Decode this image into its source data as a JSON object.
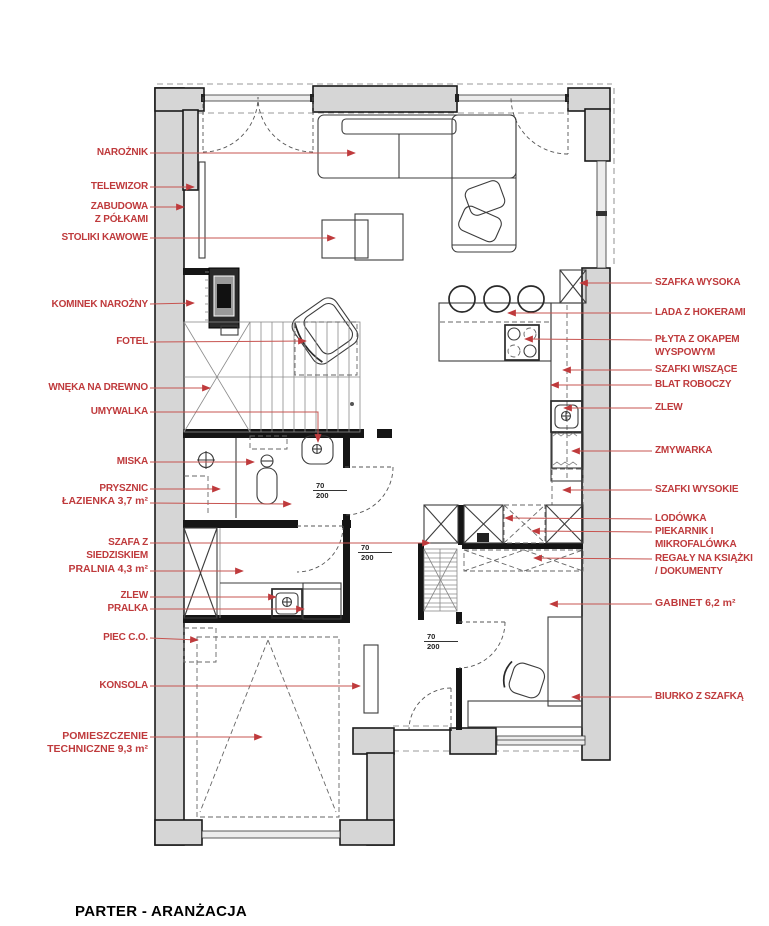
{
  "title": "PARTER - ARANŻACJA",
  "colors": {
    "annotation": "#bf3a3c",
    "leader": "#c75450",
    "wall_fill": "#d6d6d6",
    "wall_stroke": "#1a1a1a"
  },
  "plan": {
    "door_dimensions": [
      {
        "width": "70",
        "height": "200"
      },
      {
        "width": "70",
        "height": "200"
      },
      {
        "width": "70",
        "height": "200"
      }
    ]
  },
  "annotations": {
    "left": [
      {
        "id": "naroznik",
        "lines": [
          "NAROŻNIK"
        ]
      },
      {
        "id": "telewizor",
        "lines": [
          "TELEWIZOR"
        ]
      },
      {
        "id": "zabudowa",
        "lines": [
          "ZABUDOWA",
          "Z PÓŁKAMI"
        ]
      },
      {
        "id": "stoliki",
        "lines": [
          "STOLIKI KAWOWE"
        ]
      },
      {
        "id": "kominek",
        "lines": [
          "KOMINEK NAROŻNY"
        ]
      },
      {
        "id": "fotel",
        "lines": [
          "FOTEL"
        ]
      },
      {
        "id": "wneka",
        "lines": [
          "WNĘKA NA DREWNO"
        ]
      },
      {
        "id": "umywalka",
        "lines": [
          "UMYWALKA"
        ]
      },
      {
        "id": "miska",
        "lines": [
          "MISKA"
        ]
      },
      {
        "id": "prysznic",
        "lines": [
          "PRYSZNIC"
        ]
      },
      {
        "id": "lazienka",
        "lines": [
          "ŁAZIENKA 3,7 m²"
        ]
      },
      {
        "id": "szafa",
        "lines": [
          "SZAFA Z",
          "SIEDZISKIEM"
        ]
      },
      {
        "id": "pralnia",
        "lines": [
          "PRALNIA 4,3 m²"
        ]
      },
      {
        "id": "zlew-lewy",
        "lines": [
          "ZLEW"
        ]
      },
      {
        "id": "pralka",
        "lines": [
          "PRALKA"
        ]
      },
      {
        "id": "piec",
        "lines": [
          "PIEC C.O."
        ]
      },
      {
        "id": "konsola",
        "lines": [
          "KONSOLA"
        ]
      },
      {
        "id": "pomieszczenie",
        "lines": [
          "POMIESZCZENIE",
          "TECHNICZNE 9,3 m²"
        ]
      }
    ],
    "right": [
      {
        "id": "szafka-wysoka",
        "lines": [
          "SZAFKA WYSOKA"
        ]
      },
      {
        "id": "lada",
        "lines": [
          "LADA Z HOKERAMI"
        ]
      },
      {
        "id": "plyta",
        "lines": [
          "PŁYTA Z OKAPEM",
          "WYSPOWYM"
        ]
      },
      {
        "id": "szafki-wiszace",
        "lines": [
          "SZAFKI WISZĄCE"
        ]
      },
      {
        "id": "blat",
        "lines": [
          "BLAT ROBOCZY"
        ]
      },
      {
        "id": "zlew-prawy",
        "lines": [
          "ZLEW"
        ]
      },
      {
        "id": "zmywarka",
        "lines": [
          "ZMYWARKA"
        ]
      },
      {
        "id": "szafki-wysokie",
        "lines": [
          "SZAFKI WYSOKIE"
        ]
      },
      {
        "id": "lodowka",
        "lines": [
          "LODÓWKA",
          "PIEKARNIK I",
          "MIKROFALÓWKA"
        ]
      },
      {
        "id": "regaly",
        "lines": [
          "REGAŁY NA KSIĄŻKI",
          "/ DOKUMENTY"
        ]
      },
      {
        "id": "gabinet",
        "lines": [
          "GABINET 6,2 m²"
        ]
      },
      {
        "id": "biurko",
        "lines": [
          "BIURKO Z SZAFKĄ"
        ]
      }
    ]
  }
}
